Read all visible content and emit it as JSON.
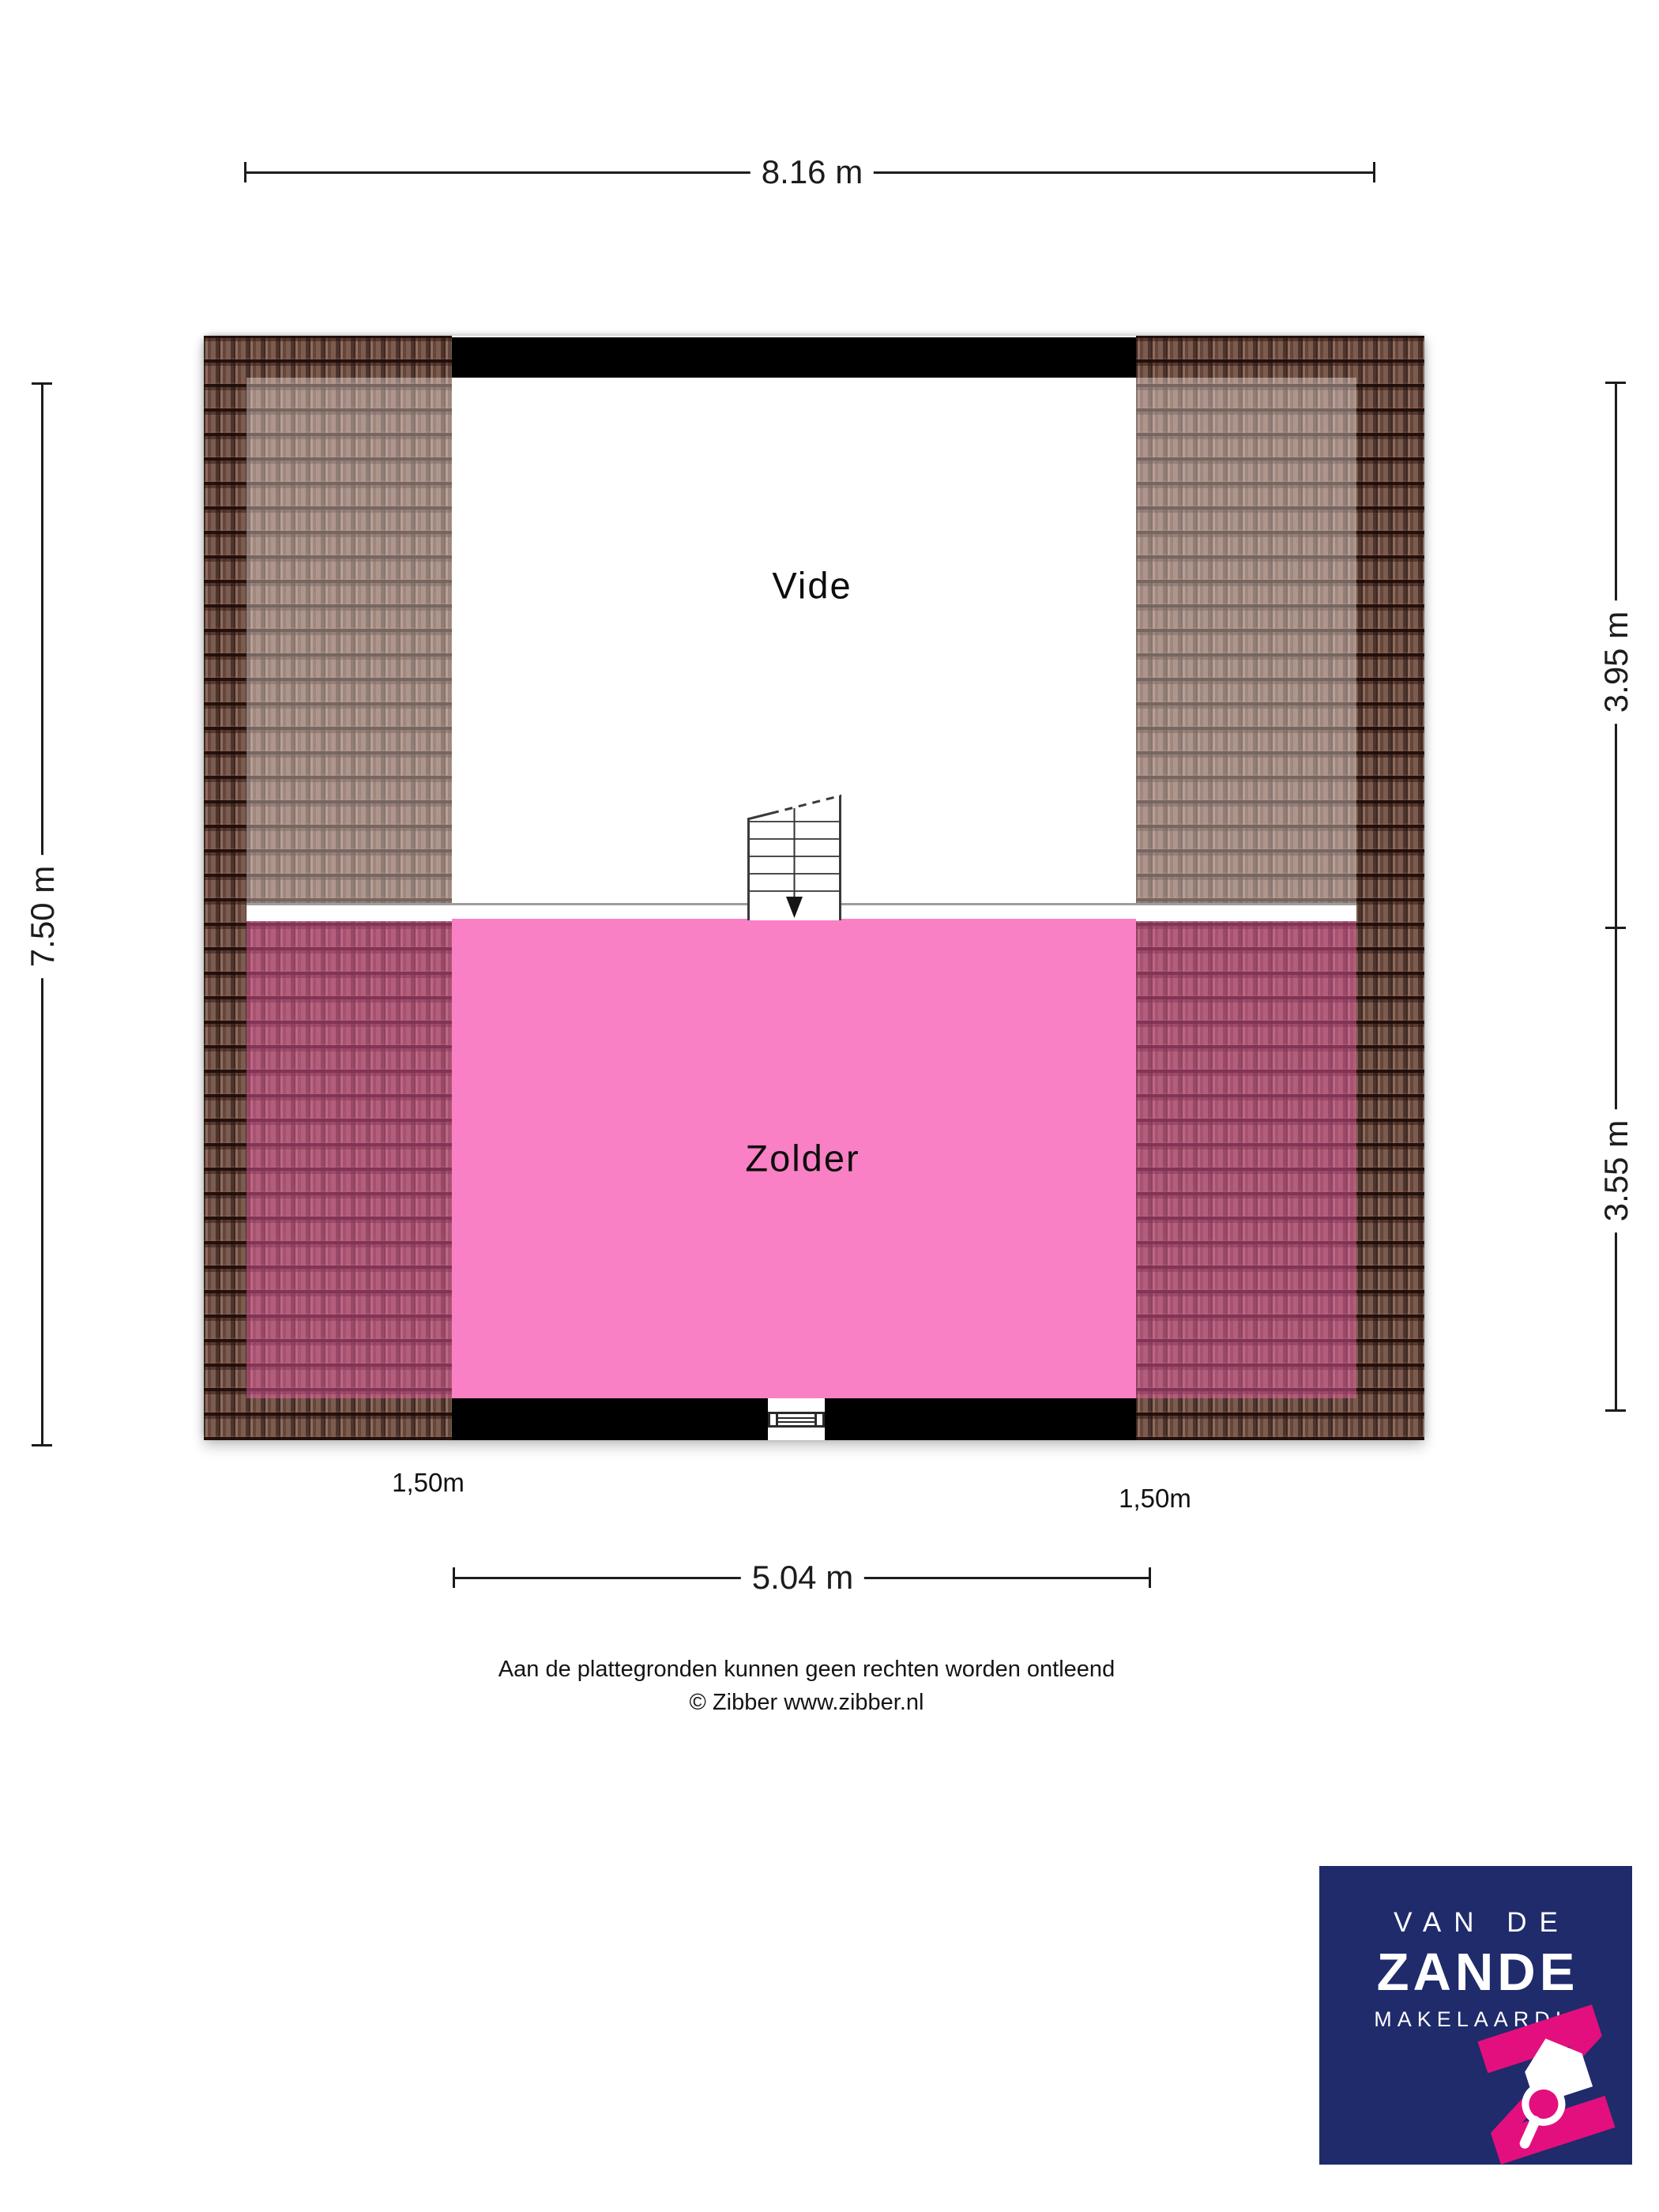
{
  "floorplan": {
    "rooms": [
      {
        "label": "Vide",
        "fill": "#ffffff"
      },
      {
        "label": "Zolder",
        "fill": "#f980c4"
      }
    ],
    "dimensions": {
      "overall_width": "8.16 m",
      "overall_depth": "7.50 m",
      "vide_depth": "3.95 m",
      "zolder_depth": "3.55 m",
      "zolder_inner_width": "5.04 m",
      "knee_wall_left": "1,50m",
      "knee_wall_right": "1,50m"
    },
    "icons": {
      "stairs": "staircase-with-down-arrow",
      "window": "window-symbol"
    },
    "colors": {
      "zolder_pink": "#f980c4",
      "roof_tile_base": "#6d4c40",
      "wall_black": "#000000"
    }
  },
  "disclaimer": {
    "line1": "Aan de plattegronden kunnen geen rechten worden ontleend",
    "line2": "© Zibber www.zibber.nl"
  },
  "logo": {
    "line1": "VAN DE",
    "line2": "ZANDE",
    "line3": "MAKELAARDIJ",
    "mark": "pink-z-ribbon-house-magnifier",
    "navy": "#1f2b6b",
    "magenta": "#e40f7e"
  }
}
